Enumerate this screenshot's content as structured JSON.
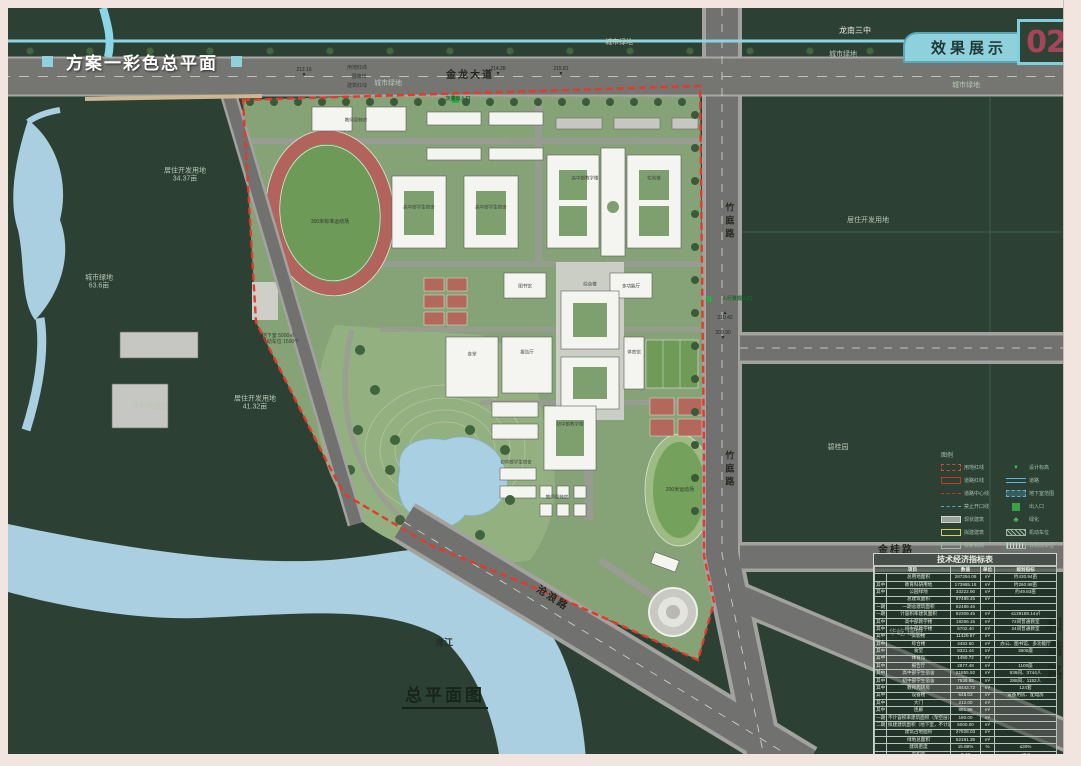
{
  "page": {
    "title": "方案一彩色总平面",
    "tab_label": "效果展示",
    "page_number": "02",
    "caption": "总平面图"
  },
  "colors": {
    "accent_cyan": "#8ed0db",
    "boundary_red": "#e8372b",
    "page_number_red": "#a8445a",
    "frame_pink": "#f2e4de"
  },
  "legend": {
    "title": "图例",
    "left": [
      {
        "name": "legend-site-redline",
        "label": "用地红线",
        "type": "red-dash"
      },
      {
        "name": "legend-road-redline",
        "label": "道路红线",
        "type": "red-solid"
      },
      {
        "name": "legend-road-centerline",
        "label": "道路中心线",
        "type": "red-dashdot"
      },
      {
        "name": "legend-no-opening-line",
        "label": "禁止开口线",
        "type": "blue-dash"
      },
      {
        "name": "legend-existing-building",
        "label": "现状建筑",
        "type": "gray-box"
      },
      {
        "name": "legend-proposed-building",
        "label": "拟建建筑",
        "type": "yellow-box"
      },
      {
        "name": "legend-existing-elevation",
        "label": "现状标高",
        "type": "elev-box"
      }
    ],
    "right": [
      {
        "name": "legend-design-elevation",
        "label": "设计标高",
        "type": "tri"
      },
      {
        "name": "legend-road",
        "label": "道路",
        "type": "road"
      },
      {
        "name": "legend-basement-extent",
        "label": "地下室范围",
        "type": "cyan-box"
      },
      {
        "name": "legend-entrance",
        "label": "出入口",
        "type": "green-box"
      },
      {
        "name": "legend-greening",
        "label": "绿化",
        "type": "tree"
      },
      {
        "name": "legend-car-parking",
        "label": "机动车位",
        "type": "hatch"
      },
      {
        "name": "legend-bike-parking",
        "label": "非机动车位",
        "type": "stripes"
      }
    ]
  },
  "table": {
    "title": "技术经济指标表",
    "headers": [
      "项目",
      "数值",
      "单位",
      "规划指标"
    ],
    "rows": [
      [
        "",
        "总用地面积",
        "287294.08",
        "m²",
        "约430.94亩"
      ],
      [
        "其中",
        "教育科研用地",
        "173985.18",
        "m²",
        "约260.98亩"
      ],
      [
        "其中",
        "公园绿地",
        "33222.90",
        "m²",
        "约49.83亩"
      ],
      [
        "",
        "总建筑面积",
        "87499.45",
        "m²",
        ""
      ],
      [
        "一期",
        "一期总建筑面积",
        "82489.45",
        "",
        ""
      ],
      [
        "一期",
        "计容积率建筑面积",
        "82309.45",
        "m²",
        "≤139188.14㎡"
      ],
      [
        "其中",
        "高中部教学楼",
        "18266.15",
        "m²",
        "72间普通教室"
      ],
      [
        "其中",
        "初中部教学楼",
        "6702.40",
        "m²",
        "24间普通教室"
      ],
      [
        "其中",
        "实验楼",
        "11429.87",
        "m²",
        ""
      ],
      [
        "其中",
        "综合楼",
        "4482.60",
        "m²",
        "办公、图书馆、多功能厅"
      ],
      [
        "其中",
        "食堂",
        "8321.44",
        "m²",
        "3600座"
      ],
      [
        "其中",
        "体育馆",
        "1450.72",
        "m²",
        ""
      ],
      [
        "其中",
        "报告厅",
        "2877.48",
        "m²",
        "1100座"
      ],
      [
        "其中",
        "高中部学生宿舍",
        "21855.92",
        "m²",
        "936间、3744人"
      ],
      [
        "其中",
        "初中部学生宿舍",
        "7936.92",
        "m²",
        "288间、1152人"
      ],
      [
        "其中",
        "教师周转房",
        "18443.72",
        "m²",
        "124套"
      ],
      [
        "其中",
        "设备楼",
        "548.03",
        "m²",
        "设备用房、配电房"
      ],
      [
        "其中",
        "大门",
        "212.00",
        "m²",
        ""
      ],
      [
        "其中",
        "连廊",
        "861.98",
        "m²",
        ""
      ],
      [
        "一期",
        "不计容积率建筑面积（架空层）",
        "180.00",
        "m²",
        ""
      ],
      [
        "二期",
        "拟建建筑面积（地下室，不计容）",
        "5000.00",
        "m²",
        ""
      ],
      [
        "",
        "建筑占地面积",
        "27628.03",
        "m²",
        ""
      ],
      [
        "",
        "绿地总面积",
        "52191.35",
        "m²",
        ""
      ],
      [
        "",
        "建筑密度",
        "15.88%",
        "%",
        "≤30%"
      ],
      [
        "",
        "容积率",
        "0.47",
        "",
        "≤0.8"
      ],
      [
        "",
        "绿地率",
        "30.00%",
        "%",
        "≥30%"
      ],
      [
        "",
        "机动车停车位",
        "163",
        "个",
        "≥1.5个/100名学生"
      ],
      [
        "",
        "非机动车停车位",
        "1500",
        "个",
        "6-8个/100名学生"
      ]
    ]
  },
  "map_labels": [
    {
      "name": "label-longnan-school",
      "text": "龙南三中",
      "x": 855,
      "y": 31,
      "cls": "lbl-white"
    },
    {
      "name": "label-city-green-1",
      "text": "城市绿地",
      "x": 619,
      "y": 43,
      "cls": "lbl-dim"
    },
    {
      "name": "label-city-green-2",
      "text": "城市绿地",
      "x": 843,
      "y": 55,
      "cls": "lbl-dim"
    },
    {
      "name": "label-city-green-3",
      "text": "城市绿地",
      "x": 966,
      "y": 86,
      "cls": "lbl-dim"
    },
    {
      "name": "label-city-green-4",
      "text": "城市绿地",
      "x": 388,
      "y": 84,
      "cls": "lbl-dim"
    },
    {
      "name": "label-road-jinlong",
      "text": "金龙大道",
      "x": 470,
      "y": 76,
      "cls": "lbl-road"
    },
    {
      "name": "label-road-zhuting-top",
      "text": "竹庭路",
      "x": 729,
      "y": 222,
      "cls": "lbl-road-v"
    },
    {
      "name": "label-road-zhuting-bottom",
      "text": "竹庭路",
      "x": 729,
      "y": 470,
      "cls": "lbl-road-v"
    },
    {
      "name": "label-road-hexie",
      "text": "和谐路",
      "x": 1052,
      "y": 652,
      "cls": "lbl-road-v lbl-big"
    },
    {
      "name": "label-road-jingui",
      "text": "金桂路",
      "x": 896,
      "y": 551,
      "cls": "lbl-road"
    },
    {
      "name": "label-road-canglang",
      "text": "沧浪路",
      "x": 552,
      "y": 599,
      "cls": "lbl-road",
      "rot": 33
    },
    {
      "name": "label-river-xiaojiang",
      "text": "潇江",
      "x": 444,
      "y": 643,
      "cls": "lbl-dark"
    },
    {
      "name": "label-residential-3437",
      "text": "居住开发用地\n34.37亩",
      "x": 185,
      "y": 176,
      "cls": "lbl-dim"
    },
    {
      "name": "label-city-green-636",
      "text": "城市绿地\n63.6亩",
      "x": 99,
      "y": 283,
      "cls": "lbl-dim"
    },
    {
      "name": "label-walton-hotel",
      "text": "沃尔顿酒店",
      "x": 150,
      "y": 407,
      "cls": "lbl-dim"
    },
    {
      "name": "label-residential-4132",
      "text": "居住开发用地\n41.32亩",
      "x": 255,
      "y": 404,
      "cls": "lbl-dim"
    },
    {
      "name": "label-residential-right",
      "text": "居住开发用地",
      "x": 868,
      "y": 221,
      "cls": "lbl-dim"
    },
    {
      "name": "label-biguiyuan",
      "text": "碧桂园",
      "x": 838,
      "y": 448,
      "cls": "lbl-dim"
    },
    {
      "name": "label-huayi-ruifu",
      "text": "华屹 瑞府",
      "x": 906,
      "y": 633,
      "cls": "lbl-white"
    },
    {
      "name": "label-secondary-entrance",
      "text": "次要出入口",
      "x": 458,
      "y": 99,
      "cls": "lbl-green"
    },
    {
      "name": "label-pedestrian-entrance",
      "text": "人行景观入口",
      "x": 737,
      "y": 299,
      "cls": "lbl-green"
    },
    {
      "name": "label-basement-note",
      "text": "地下室 5000㎡\n非机动车位 1500个",
      "x": 278,
      "y": 339,
      "cls": "lbl-tiny"
    },
    {
      "name": "label-redline-callout",
      "text": "用地红线",
      "x": 357,
      "y": 68,
      "cls": "lbl-tiny"
    },
    {
      "name": "label-wallline-callout",
      "text": "围墙线",
      "x": 359,
      "y": 77,
      "cls": "lbl-tiny"
    },
    {
      "name": "label-buildingline-callout",
      "text": "建筑红线",
      "x": 357,
      "y": 86,
      "cls": "lbl-tiny"
    },
    {
      "name": "label-track-300",
      "text": "300米标准运动场",
      "x": 330,
      "y": 222,
      "cls": "lbl-tiny"
    },
    {
      "name": "label-track-200",
      "text": "200米运动场",
      "x": 680,
      "y": 490,
      "cls": "lbl-tiny"
    },
    {
      "name": "elevation-21428",
      "text": "214.28\n▼",
      "x": 498,
      "y": 72,
      "cls": "lbl-elev"
    },
    {
      "name": "elevation-21581",
      "text": "215.81\n▼",
      "x": 561,
      "y": 72,
      "cls": "lbl-elev"
    },
    {
      "name": "elevation-21216",
      "text": "212.16\n▼",
      "x": 304,
      "y": 73,
      "cls": "lbl-elev"
    },
    {
      "name": "elevation-21042",
      "text": "▲\n210.42",
      "x": 725,
      "y": 316,
      "cls": "lbl-elev"
    },
    {
      "name": "elevation-20990",
      "text": "209.90\n▼",
      "x": 723,
      "y": 336,
      "cls": "lbl-elev"
    },
    {
      "name": "building-label-teacher-housing",
      "text": "教师周转房",
      "x": 356,
      "y": 120,
      "cls": "lbl-bldg"
    },
    {
      "name": "building-label-hs-dorm-1",
      "text": "高中部学生宿舍",
      "x": 419,
      "y": 207,
      "cls": "lbl-bldg"
    },
    {
      "name": "building-label-hs-dorm-2",
      "text": "高中部学生宿舍",
      "x": 491,
      "y": 207,
      "cls": "lbl-bldg"
    },
    {
      "name": "building-label-hs-teaching",
      "text": "高中部教学楼",
      "x": 585,
      "y": 178,
      "cls": "lbl-bldg"
    },
    {
      "name": "building-label-lab",
      "text": "实验楼",
      "x": 654,
      "y": 178,
      "cls": "lbl-bldg"
    },
    {
      "name": "building-label-library",
      "text": "图书馆",
      "x": 525,
      "y": 286,
      "cls": "lbl-bldg"
    },
    {
      "name": "building-label-multihall",
      "text": "多功能厅",
      "x": 631,
      "y": 286,
      "cls": "lbl-bldg"
    },
    {
      "name": "building-label-complex",
      "text": "综合楼",
      "x": 590,
      "y": 284,
      "cls": "lbl-bldg"
    },
    {
      "name": "building-label-lecture-hall",
      "text": "报告厅",
      "x": 527,
      "y": 352,
      "cls": "lbl-bldg"
    },
    {
      "name": "building-label-canteen",
      "text": "食堂",
      "x": 472,
      "y": 354,
      "cls": "lbl-bldg"
    },
    {
      "name": "building-label-gym",
      "text": "体育馆",
      "x": 634,
      "y": 352,
      "cls": "lbl-bldg"
    },
    {
      "name": "building-label-ms-teaching",
      "text": "初中部教学楼",
      "x": 570,
      "y": 424,
      "cls": "lbl-bldg"
    },
    {
      "name": "building-label-ms-dorm",
      "text": "初中部学生宿舍",
      "x": 516,
      "y": 462,
      "cls": "lbl-bldg"
    },
    {
      "name": "building-label-teacher-housing-2",
      "text": "教师周转房",
      "x": 557,
      "y": 497,
      "cls": "lbl-bldg"
    }
  ]
}
